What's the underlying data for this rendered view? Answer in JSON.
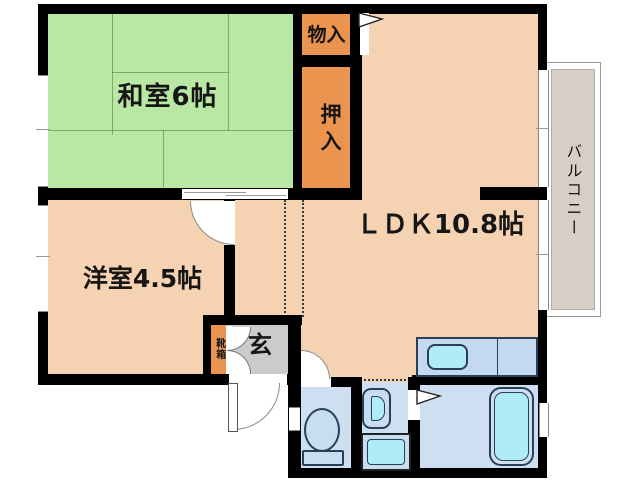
{
  "floorplan": {
    "rooms": {
      "washitsu": {
        "label": "和室6帖"
      },
      "monoire": {
        "label": "物入"
      },
      "oshiire": {
        "label": "押入"
      },
      "ldk": {
        "label": "ＬＤＫ10.8帖"
      },
      "yoshitsu": {
        "label": "洋室4.5帖"
      },
      "genkan": {
        "label": "玄"
      },
      "kutsubako": {
        "label": "靴箱"
      },
      "balcony": {
        "label": "バルコニー"
      }
    },
    "fixtures": {
      "kitchen_counter": "kitchen-counter",
      "kitchen_sink": "kitchen-sink",
      "bathtub": "bathtub",
      "toilet": "toilet",
      "washing_machine": "washing-machine",
      "vanity": "vanity-sink"
    },
    "colors": {
      "tatami_green": "#b9e8a5",
      "room_peach": "#f4d2b2",
      "closet_orange": "#ea9450",
      "genkan_gray": "#cbcbcb",
      "balcony_tan": "#d7cec5",
      "wet_blue": "#cfdff2",
      "wet_blue_light": "#c6ddf2",
      "fixture_cyan": "#b0ebf8",
      "fixture_line": "#2a4a66",
      "wall_black": "#000000"
    }
  }
}
